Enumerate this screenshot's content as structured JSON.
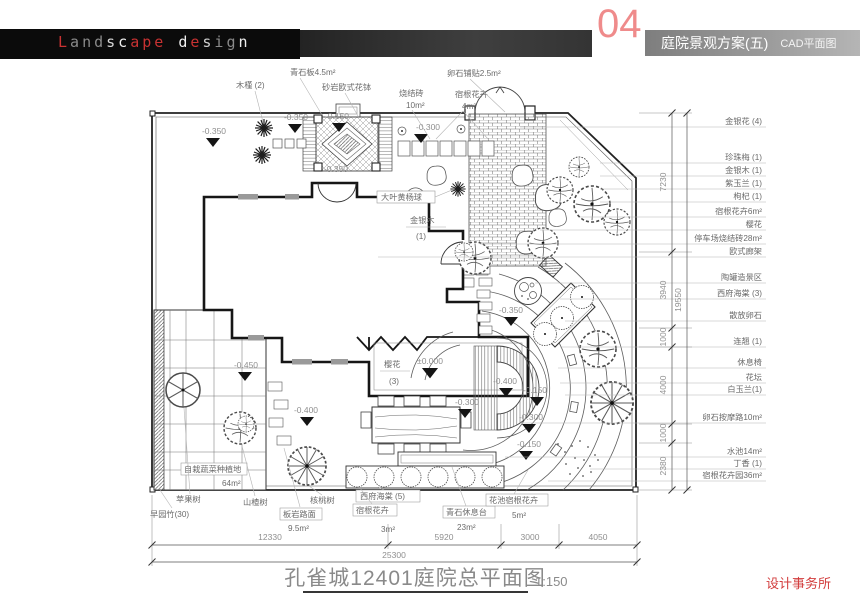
{
  "header": {
    "logo_letters": [
      {
        "ch": "L",
        "c": "#c83232"
      },
      {
        "ch": "a",
        "c": "#8a8a8a"
      },
      {
        "ch": "n",
        "c": "#8a8a8a"
      },
      {
        "ch": "d",
        "c": "#8a8a8a"
      },
      {
        "ch": "s",
        "c": "#d8d8d8"
      },
      {
        "ch": "c",
        "c": "#f0f0f0"
      },
      {
        "ch": "a",
        "c": "#c83232"
      },
      {
        "ch": "p",
        "c": "#c83232"
      },
      {
        "ch": "e",
        "c": "#c83232"
      },
      {
        "ch": " ",
        "c": "#000000"
      },
      {
        "ch": "d",
        "c": "#f0f0f0"
      },
      {
        "ch": "e",
        "c": "#c83232"
      },
      {
        "ch": "s",
        "c": "#cfcfcf"
      },
      {
        "ch": "i",
        "c": "#8a8a8a"
      },
      {
        "ch": "g",
        "c": "#8a8a8a"
      },
      {
        "ch": "n",
        "c": "#f0f0f0"
      }
    ],
    "sheet_number": "04",
    "accent_color": "#ef8b8b",
    "bar_title": "庭院景观方案(五)",
    "bar_subtitle": "CAD平面图"
  },
  "plan": {
    "top_labels": [
      "木槿 (2)",
      "青石板4.5m²",
      "砂岩欧式花钵",
      "烧结砖",
      "10m²",
      "卵石铺贴2.5m²",
      "宿根花卉",
      "4m²"
    ],
    "right_labels": [
      "金银花 (4)",
      "珍珠梅 (1)",
      "金银木 (1)",
      "紫玉兰 (1)",
      "枸杞 (1)",
      "宿根花卉6m²",
      "樱花",
      "停车场烧结砖28m²",
      "欧式廊架",
      "陶罐造景区",
      "西府海棠 (3)",
      "散放卵石",
      "连翘 (1)",
      "休息椅",
      "花坛",
      "白玉兰(1)",
      "卵石按摩路10m²",
      "水池14m²",
      "丁香 (1)",
      "宿根花卉园36m²"
    ],
    "bottom_labels": [
      "苹果树",
      "早园竹(30)",
      "自栽蔬菜种植地",
      "64m²",
      "山楂树",
      "板岩路面",
      "9.5m²",
      "核桃树",
      "西府海棠 (5)",
      "宿根花卉",
      "3m²",
      "青石休息台",
      "23m²",
      "花池宿根花卉",
      "5m²"
    ],
    "inplan": {
      "boxwood": "大叶黄杨球",
      "jinyinmu": "金银木",
      "jinyinmu_count": "(1)",
      "yinghua": "樱花",
      "yinghua_count": "(3)"
    },
    "elev": {
      "zero": "±0.000",
      "n150": "-0.150",
      "n300": "-0.300",
      "n350": "-0.350",
      "n400": "-0.400",
      "n450": "-0.450"
    },
    "dims": {
      "bottom": [
        "12330",
        "5920",
        "3000",
        "4050"
      ],
      "bottom_total": "25300",
      "right": [
        "7230",
        "3940",
        "1000",
        "4000",
        "1000",
        "2380"
      ],
      "right_total": "19550"
    }
  },
  "title_block": {
    "title": "孔雀城12401庭院总平面图",
    "scale": "1:150",
    "firm": "设计事务所"
  }
}
